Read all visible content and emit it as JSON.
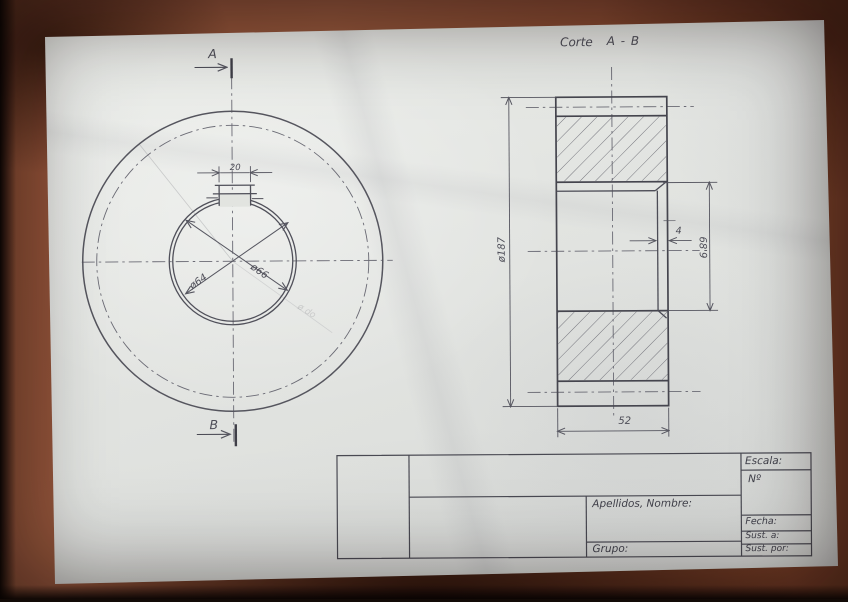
{
  "photo": {
    "background_color": "#8d4e35",
    "paper_color": "#e4e6e2",
    "pencil_color": "#54545e"
  },
  "annotation": {
    "corte_label": "Corte",
    "corte_cut": "A - B"
  },
  "front_view": {
    "section_arrow_top": "A",
    "section_arrow_bottom": "B",
    "keyway_width": "20",
    "bore_dia": "ø64",
    "hub_dia": "ø66",
    "faint_mark": "ø do"
  },
  "section_view": {
    "outer_dia": "ø187",
    "keyway_dia": "68'9",
    "keyway_depth": "4",
    "width": "52"
  },
  "title_block": {
    "escala": "Escala:",
    "numero": "Nº",
    "apellidos_nombre": "Apellidos, Nombre:",
    "grupo": "Grupo:",
    "fecha": "Fecha:",
    "sust_a": "Sust. a:",
    "sust_por": "Sust. por:"
  }
}
